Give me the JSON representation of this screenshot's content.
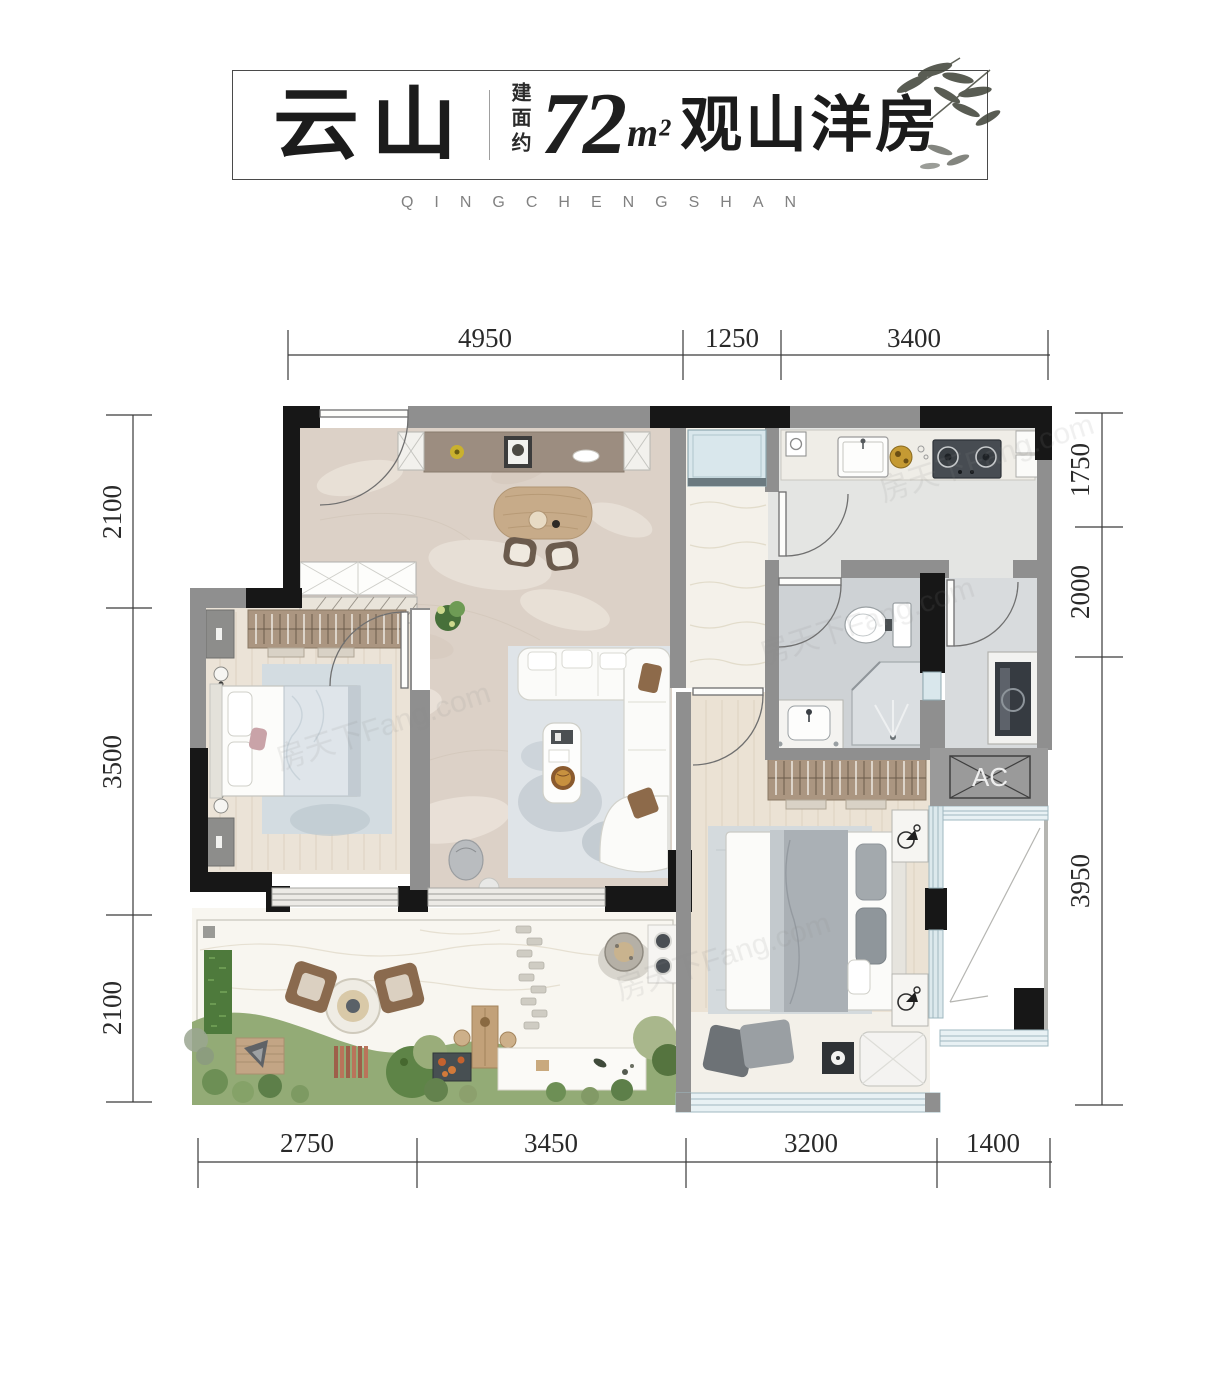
{
  "header": {
    "logo": "云山",
    "area_label": "建面约",
    "area_value": "72",
    "area_unit": "m²",
    "product_name": "观山洋房",
    "subtitle": "QINGCHENGSHAN"
  },
  "floor_plan": {
    "ac_label": "AC",
    "dimensions_mm": {
      "top": [
        "4950",
        "1250",
        "3400"
      ],
      "bottom": [
        "2750",
        "3450",
        "3200",
        "1400"
      ],
      "left": [
        "2100",
        "3500",
        "2100"
      ],
      "right": [
        "1750",
        "2000",
        "3950"
      ]
    }
  },
  "watermark": {
    "text": "房天下Fang.com"
  },
  "colors": {
    "wall_black": "#171717",
    "wall_gray": "#8f8f8f",
    "marble_floor": "#dcd1c7",
    "wood_floor": "#ebe2d4",
    "tile_floor": "#ced2d5",
    "window_blue": "#d9e7ec",
    "terrace_sand": "#f8f6f0",
    "lawn_green": "#93ab76",
    "wardrobe_wood": "#ab9681"
  }
}
